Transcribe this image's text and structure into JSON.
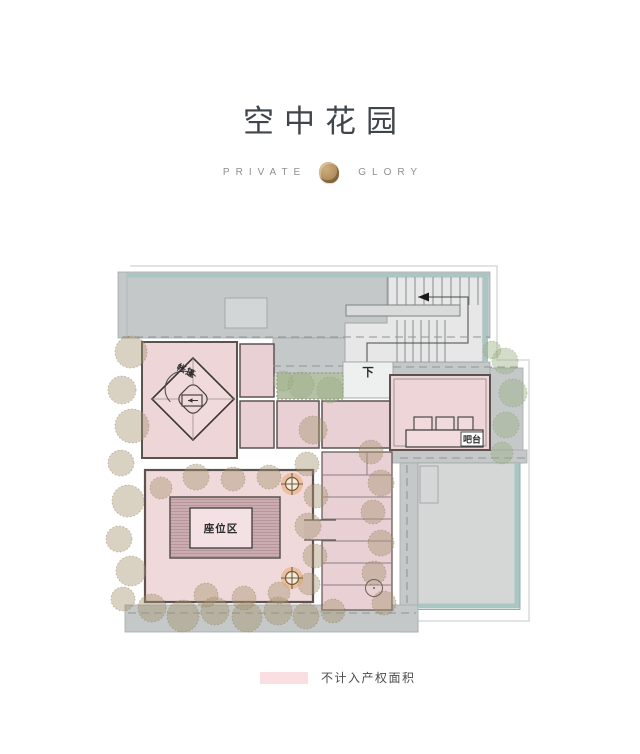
{
  "header": {
    "title": "空中花园",
    "subtitle_left": "PRIVATE",
    "subtitle_right": "GLORY"
  },
  "plan": {
    "labels": {
      "tent": "帐篷",
      "down": "下",
      "bar": "吧台",
      "seating": "座位区"
    }
  },
  "legend": {
    "label": "不计入产权面积",
    "swatch_color": "#fadfe2"
  },
  "palette": {
    "title_color": "#3f454b",
    "subtitle_color": "#8f8f8f",
    "seal_gold": "#b3905f",
    "area_pink": "#ecd4d7",
    "roof_gray": "#c5c8c8",
    "stair_gray": "#e6e7e6",
    "roof_light_gray": "#d5d7d7",
    "teal_edge": "#a9c5c4",
    "tree_brown": "#a5916e",
    "tree_green": "#9eb087",
    "torch_orange": "#eaa45f",
    "deck_mauve": "#cbadb1"
  }
}
